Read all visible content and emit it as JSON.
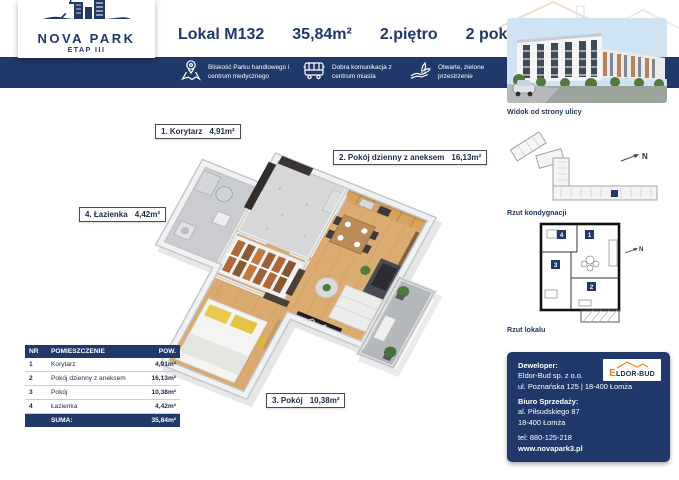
{
  "brand": {
    "name": "NOVA PARK",
    "etap": "ETAP III"
  },
  "header": {
    "unit": "Lokal M132",
    "area": "35,84m²",
    "floor": "2.piętro",
    "rooms": "2 pokoje"
  },
  "features": [
    {
      "icon": "location-pin-icon",
      "text": "Bliskość Parku handlowego i centrum medycznego"
    },
    {
      "icon": "bus-icon",
      "text": "Dobra komunikacja z centrum miasta"
    },
    {
      "icon": "plant-hand-icon",
      "text": "Otwarte, zielone przestrzenie"
    }
  ],
  "plan_labels": [
    {
      "name": "1. Korytarz",
      "area": "4,91m²"
    },
    {
      "name": "2. Pokój dzienny z aneksem",
      "area": "16,13m²"
    },
    {
      "name": "3. Pokój",
      "area": "10,38m²"
    },
    {
      "name": "4. Łazienka",
      "area": "4,42m²"
    }
  ],
  "room_table": {
    "headers": [
      "NR",
      "POMIESZCZENIE",
      "POW."
    ],
    "rows": [
      [
        "1",
        "Korytarz",
        "4,91m²"
      ],
      [
        "2",
        "Pokój dzienny z aneksem",
        "16,13m²"
      ],
      [
        "3",
        "Pokój",
        "10,38m²"
      ],
      [
        "4",
        "Łazienka",
        "4,42m²"
      ]
    ],
    "sum_label": "SUMA:",
    "sum_value": "35,84m²"
  },
  "sidebar": {
    "photo_caption": "Widok od strony ulicy",
    "floor_plan_caption": "Rzut kondygnacji",
    "unit_plan_caption": "Rzut lokalu",
    "north_label": "N",
    "unit_plan_rooms": [
      "1",
      "2",
      "3",
      "4"
    ]
  },
  "contact": {
    "developer_label": "Deweloper:",
    "developer_name": "Eldor-Bud sp. z o.o.",
    "developer_address": "ul. Poznańska 125 | 18-400 Łomża",
    "office_label": "Biuro Sprzedaży:",
    "office_line1": "al. Piłsudskiego 87",
    "office_line2": "18-400 Łomża",
    "phone": "tel: 880-125-218",
    "website": "www.novapark3.pl",
    "logo_initial": "E",
    "logo_rest": "LDOR-BUD"
  },
  "colors": {
    "navy": "#21386a",
    "orange": "#e8802a",
    "wood": "#d8a76e",
    "dark_wall": "#35302b"
  }
}
